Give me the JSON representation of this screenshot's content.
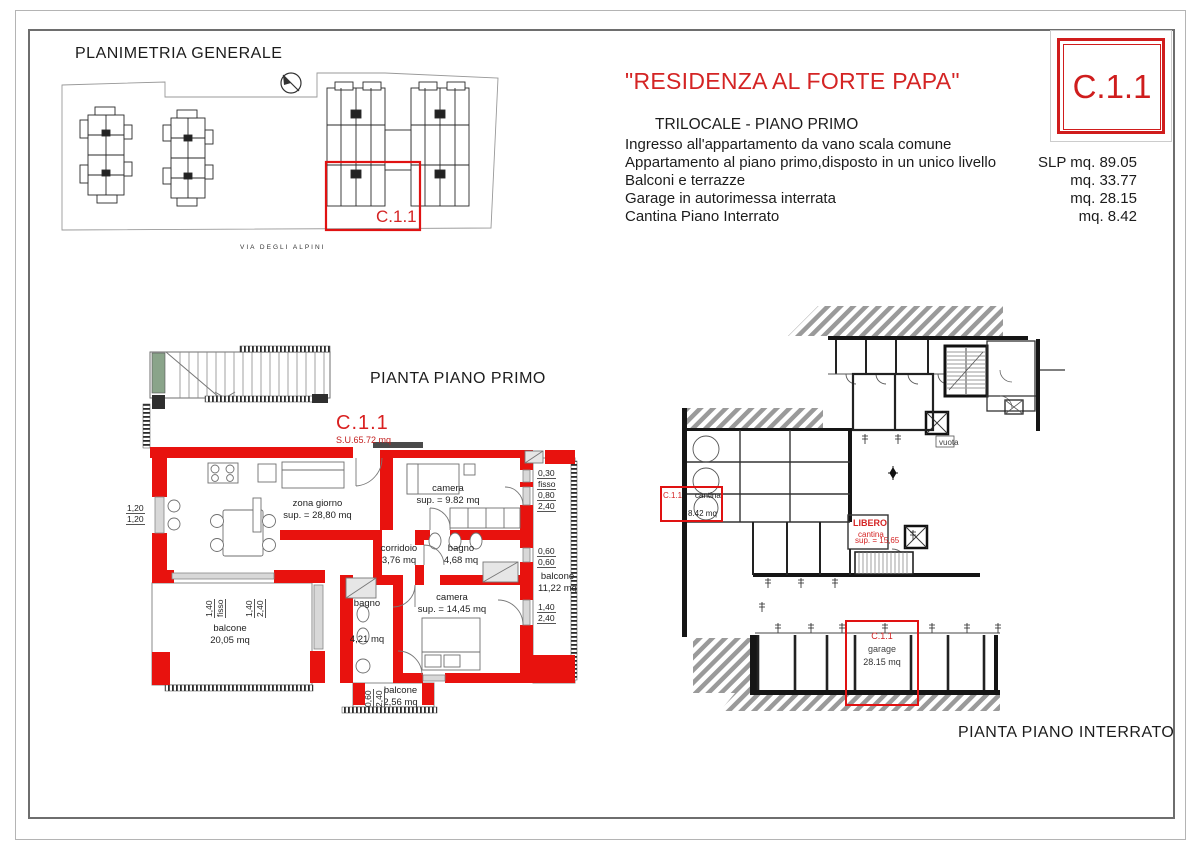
{
  "colors": {
    "accent_red": "#d42424",
    "wall_red": "#e8120e",
    "ink": "#1c1c1c",
    "line_gray": "#6f6f6f",
    "hatch_gray": "#9a9a9a",
    "stair_green": "#8aa48a"
  },
  "site_plan": {
    "title": "PLANIMETRIA GENERALE",
    "street": "VIA DEGLI ALPINI",
    "unit": "C.1.1"
  },
  "header": {
    "title": "\"RESIDENZA AL FORTE PAPA\"",
    "subtitle": "TRILOCALE - PIANO PRIMO",
    "rows": [
      {
        "label": "Ingresso all'appartamento da vano scala comune",
        "value": ""
      },
      {
        "label": "Appartamento al piano primo,disposto in un unico livello",
        "value": "SLP mq. 89.05"
      },
      {
        "label": "Balconi e terrazze",
        "value": "mq. 33.77"
      },
      {
        "label": "Garage in autorimessa interrata",
        "value": "mq. 28.15"
      },
      {
        "label": "Cantina Piano Interrato",
        "value": "mq. 8.42"
      }
    ],
    "badge": "C.1.1"
  },
  "first_floor": {
    "title": "PIANTA PIANO PRIMO",
    "unit": "C.1.1",
    "surface": "S.U.65.72 mq",
    "rooms": {
      "zona_giorno": {
        "name": "zona giorno",
        "area": "sup. = 28,80 mq"
      },
      "camera1": {
        "name": "camera",
        "area": "sup. = 9.82 mq"
      },
      "corridoio": {
        "name": "corridoio",
        "area": "3,76 mq"
      },
      "bagno1": {
        "name": "bagno",
        "area": "4,68 mq"
      },
      "camera2": {
        "name": "camera",
        "area": "sup. = 14,45 mq"
      },
      "bagno2": {
        "name": "bagno",
        "area": "4,21 mq"
      },
      "balcone1": {
        "name": "balcone",
        "area": "20,05 mq"
      },
      "balcone2": {
        "name": "balcone",
        "area": "11,22 mq"
      },
      "balcone3": {
        "name": "balcone",
        "area": "2,56 mq"
      }
    },
    "dims": {
      "left_top": "1,20",
      "left_bot": "1,20",
      "w1a": "1,40",
      "w1b": "fisso",
      "w2a": "1,40",
      "w2b": "2,40",
      "r1a": "0,30",
      "r1b": "fisso",
      "r2a": "0,80",
      "r2b": "2,40",
      "r3a": "0,60",
      "r3b": "0,60",
      "r4a": "1,40",
      "r4b": "2,40",
      "b3a": "0,60",
      "b3b": "2,40"
    }
  },
  "basement": {
    "title": "PIANTA PIANO INTERRATO",
    "cantina": {
      "unit": "C.1.1",
      "name": "cantina",
      "area": "8.42 mq"
    },
    "garage": {
      "unit": "C.1.1",
      "name": "garage",
      "area": "28.15 mq"
    },
    "libero": {
      "label": "LIBERO",
      "sub1": "cantina",
      "sub2": "sup. = 15,65"
    },
    "vuota": "vuota"
  }
}
